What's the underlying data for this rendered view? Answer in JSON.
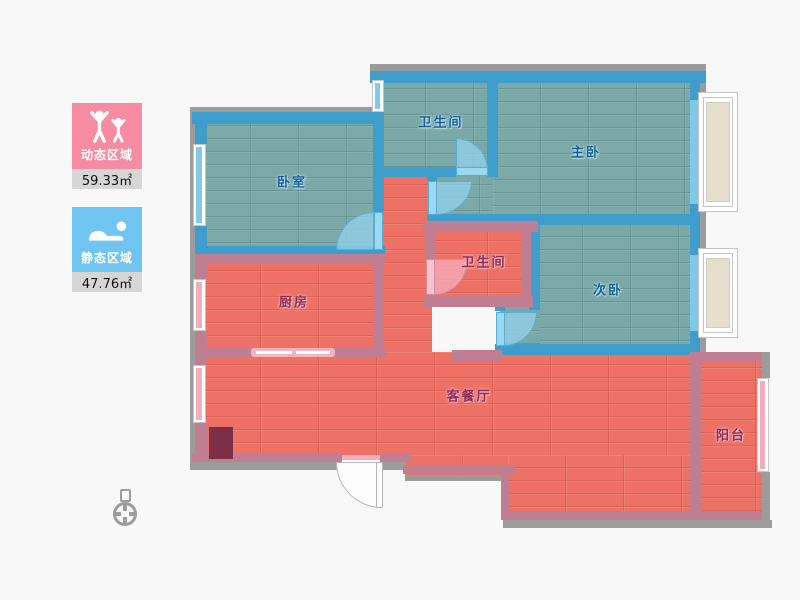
{
  "app": {
    "type": "floor-plan-viewer",
    "background": "#f8f8f8"
  },
  "legend": {
    "dynamic": {
      "label": "动态区域",
      "area": "59.33㎡",
      "color": "#f58ca1",
      "icon": "people-arms-up-icon"
    },
    "static": {
      "label": "静态区域",
      "area": "47.76㎡",
      "color": "#6fc5f0",
      "icon": "sleeping-person-icon"
    }
  },
  "rooms": [
    {
      "id": "bedroom",
      "label": "卧室",
      "zone": "static"
    },
    {
      "id": "bathroom-top",
      "label": "卫生间",
      "zone": "static"
    },
    {
      "id": "master-bedroom",
      "label": "主卧",
      "zone": "static"
    },
    {
      "id": "second-bedroom",
      "label": "次卧",
      "zone": "static"
    },
    {
      "id": "kitchen",
      "label": "厨房",
      "zone": "dynamic"
    },
    {
      "id": "bathroom-middle",
      "label": "卫生间",
      "zone": "dynamic"
    },
    {
      "id": "living-dining",
      "label": "客餐厅",
      "zone": "dynamic"
    },
    {
      "id": "balcony",
      "label": "阳台",
      "zone": "dynamic"
    }
  ],
  "colors": {
    "static_floor": "#7aa9a7",
    "dynamic_floor": "#ed7165",
    "static_wall": "#3f9dcb",
    "dynamic_wall": "#c07e93",
    "exterior_wall": "#9c9c9c",
    "bay_window_fill": "#e5dfcd",
    "cabinet": "#7c3048"
  }
}
